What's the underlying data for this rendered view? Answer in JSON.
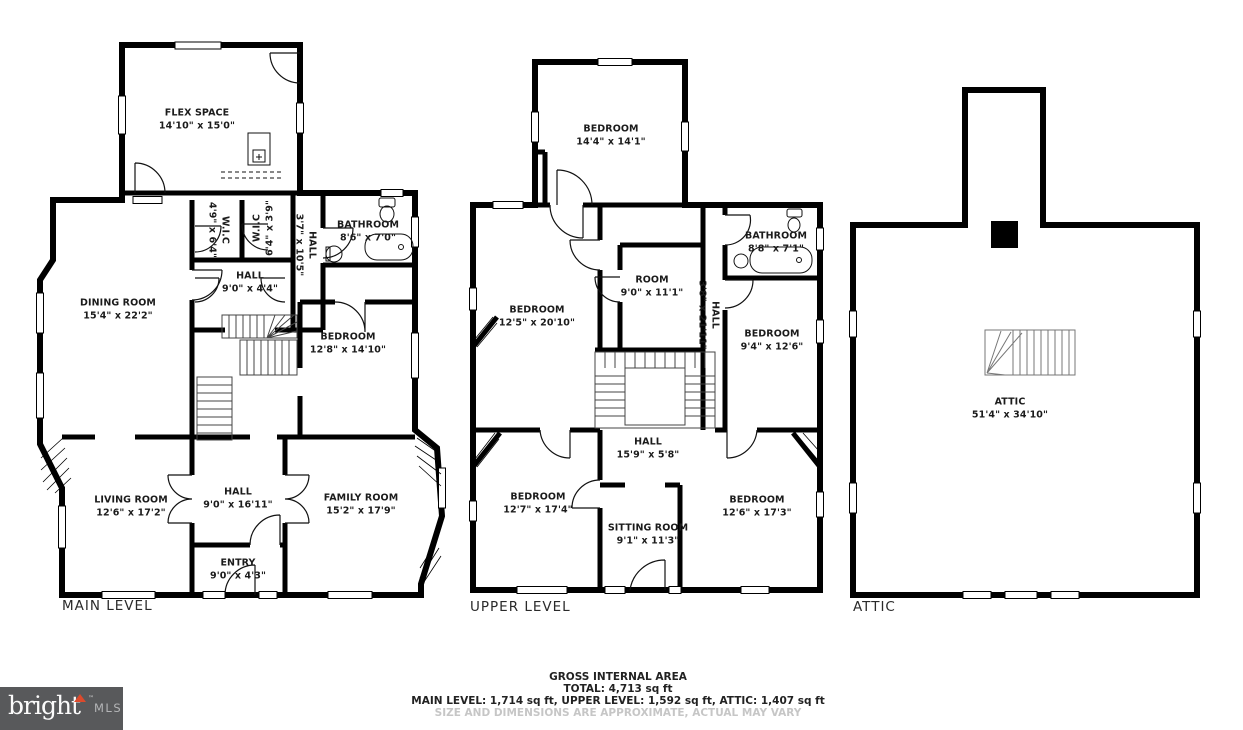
{
  "floors": {
    "main": {
      "label": "MAIN LEVEL",
      "rooms": {
        "flex_space": {
          "name": "FLEX SPACE",
          "dims": "14'10\" x 15'0\""
        },
        "dining_room": {
          "name": "DINING ROOM",
          "dims": "15'4\" x 22'2\""
        },
        "wic_left": {
          "name": "W.I.C",
          "dims": "4'9\" x 6'4\""
        },
        "wic_right": {
          "name": "W.I.C",
          "dims": "6'4\" x 3'9\""
        },
        "hall_upper": {
          "name": "HALL",
          "dims": "9'0\" x 4'4\""
        },
        "hall_side": {
          "name": "HALL",
          "dims": "3'7\" x 10'5\""
        },
        "bathroom": {
          "name": "BATHROOM",
          "dims": "8'6\" x 7'0\""
        },
        "bedroom": {
          "name": "BEDROOM",
          "dims": "12'8\" x 14'10\""
        },
        "living_room": {
          "name": "LIVING ROOM",
          "dims": "12'6\" x 17'2\""
        },
        "hall_center": {
          "name": "HALL",
          "dims": "9'0\" x 16'11\""
        },
        "family_room": {
          "name": "FAMILY ROOM",
          "dims": "15'2\" x 17'9\""
        },
        "entry": {
          "name": "ENTRY",
          "dims": "9'0\" x 4'3\""
        }
      }
    },
    "upper": {
      "label": "UPPER LEVEL",
      "rooms": {
        "bedroom_top": {
          "name": "BEDROOM",
          "dims": "14'4\" x 14'1\""
        },
        "bedroom_left": {
          "name": "BEDROOM",
          "dims": "12'5\" x 20'10\""
        },
        "room": {
          "name": "ROOM",
          "dims": "9'0\" x 11'1\""
        },
        "bathroom": {
          "name": "BATHROOM",
          "dims": "8'8\" x 7'1\""
        },
        "hall_side": {
          "name": "HALL",
          "dims": "3'8\" x 21'11\""
        },
        "bedroom_right_mid": {
          "name": "BEDROOM",
          "dims": "9'4\" x 12'6\""
        },
        "hall": {
          "name": "HALL",
          "dims": "15'9\" x 5'8\""
        },
        "bedroom_bottom_left": {
          "name": "BEDROOM",
          "dims": "12'7\" x 17'4\""
        },
        "sitting_room": {
          "name": "SITTING ROOM",
          "dims": "9'1\" x 11'3\""
        },
        "bedroom_bottom_right": {
          "name": "BEDROOM",
          "dims": "12'6\" x 17'3\""
        }
      }
    },
    "attic": {
      "label": "ATTIC",
      "rooms": {
        "attic": {
          "name": "ATTIC",
          "dims": "51'4\" x 34'10\""
        }
      }
    }
  },
  "footer": {
    "line1": "GROSS INTERNAL AREA",
    "line2": "TOTAL: 4,713 sq ft",
    "line3": "MAIN LEVEL: 1,714 sq ft, UPPER LEVEL: 1,592 sq ft, ATTIC: 1,407 sq ft",
    "disclaimer": "SIZE AND DIMENSIONS ARE APPROXIMATE, ACTUAL MAY VARY"
  },
  "logo": {
    "brand": "bright",
    "tm": "TM",
    "suffix": "MLS",
    "background": "#58595b",
    "accent": "#dc4a2c"
  },
  "colors": {
    "walls": "#000000",
    "paper": "#ffffff",
    "disclaimer_text": "#c6c6c6"
  }
}
